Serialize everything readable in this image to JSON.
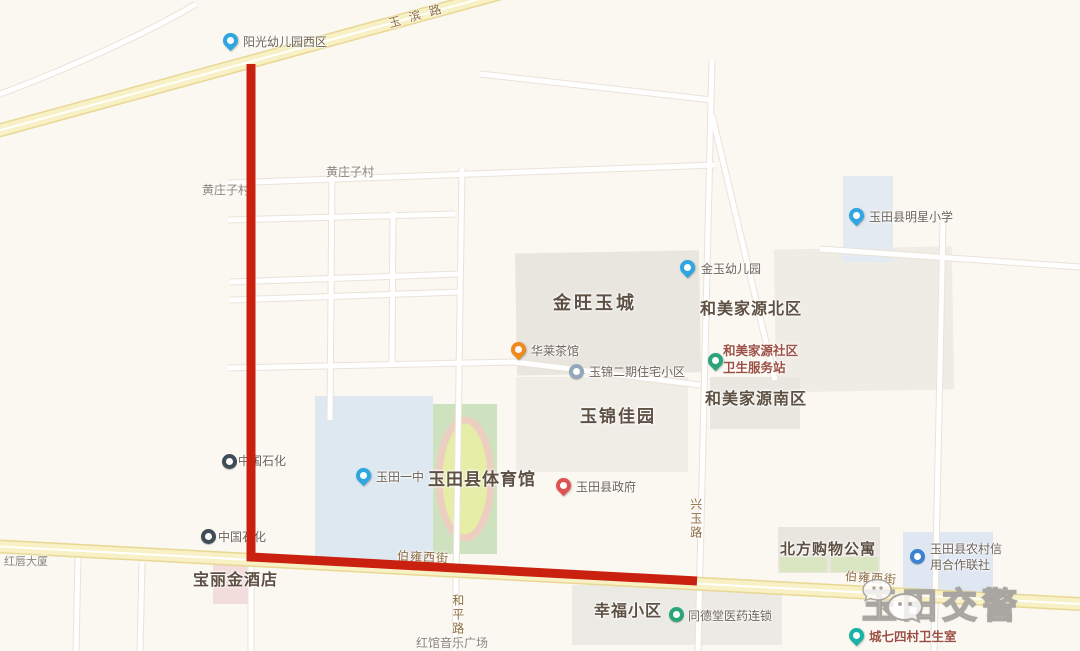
{
  "map": {
    "road_labels": {
      "yubin_road": "玉滨路",
      "boyong_west_left": "伯雍西街",
      "boyong_west_right": "伯雍西街",
      "xingyu_road": "兴玉路",
      "heping_road": "和平路"
    },
    "area_labels": {
      "jinwang_yucheng": "金旺玉城",
      "hemei_jiayuan_north": "和美家源北区",
      "hemei_jiayuan_south": "和美家源南区",
      "yujin_jiayuan": "玉锦佳园",
      "yutian_gymnasium": "玉田县体育馆",
      "beifang_shopping_apartment": "北方购物公寓",
      "baolijin_hotel": "宝丽金酒店",
      "xingfu_community": "幸福小区",
      "huangzhuangzi_village": "黄庄子村",
      "huangzhuangzi_village_west": "黄庄子村",
      "hongchun_building": "红唇大厦",
      "hongguan_music_plaza": "红馆音乐广场"
    },
    "pois": {
      "yangguang_kindergarten_west": "阳光幼儿园西区",
      "jinyu_kindergarten": "金玉幼儿园",
      "hualai_teahouse": "华莱茶馆",
      "yujin_phase2_residence": "玉锦二期住宅小区",
      "hemei_clinic_line1": "和美家源社区",
      "hemei_clinic_line2": "卫生服务站",
      "mingxing_primary_school": "玉田县明星小学",
      "sinopec_north": "中国石化",
      "sinopec_south": "中国石化",
      "yutian_no1_middle_school": "玉田一中",
      "yutian_county_government": "玉田县政府",
      "rural_credit_line1": "玉田县农村信",
      "rural_credit_line2": "用合作联社",
      "tongdetang_pharmacy": "同德堂医药连锁",
      "chengqisi_village_clinic": "城七四村卫生室"
    },
    "watermark": {
      "text": "玉田交警",
      "icon": "wechat-icon"
    },
    "colors": {
      "route_red": "#c9200f",
      "background": "#faf8f1",
      "major_road_fill": "#f8f1c6",
      "major_road_edge": "#e9d793",
      "building_gray": "#e9e6e0",
      "school_blue": "#dee8f0",
      "field_green": "#cfe2bf",
      "track_infield": "#e6eda6",
      "clinic_text": "#9c4f43",
      "pin_blue": "#2ea6e2",
      "pin_orange": "#f08a1d",
      "pin_red": "#e05252",
      "pin_green": "#2aa578",
      "pin_teal": "#17b3a5"
    }
  }
}
